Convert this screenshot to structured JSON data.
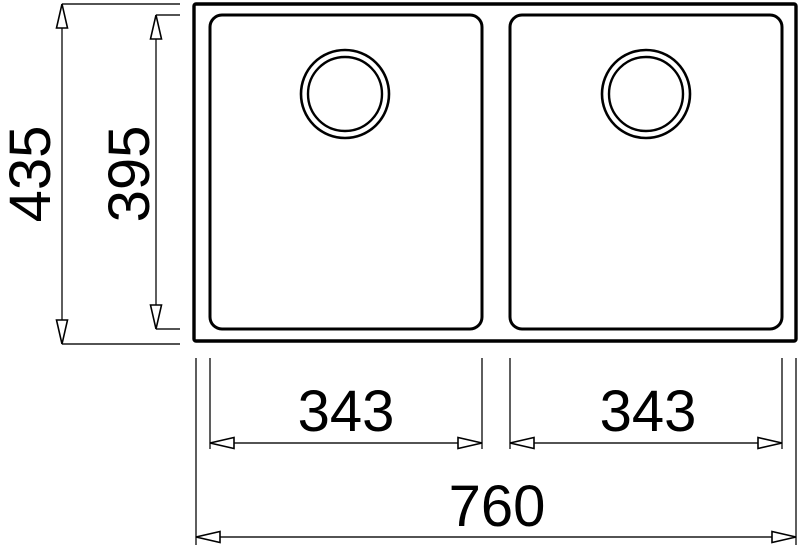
{
  "drawing": {
    "type": "technical-dimension-drawing",
    "subject": "double-bowl undermount sink, top view",
    "colors": {
      "line": "#000000",
      "background": "#ffffff"
    },
    "dimensions": {
      "overall_height": "435",
      "bowl_depth": "395",
      "left_bowl_width": "343",
      "right_bowl_width": "343",
      "overall_width": "760"
    }
  }
}
